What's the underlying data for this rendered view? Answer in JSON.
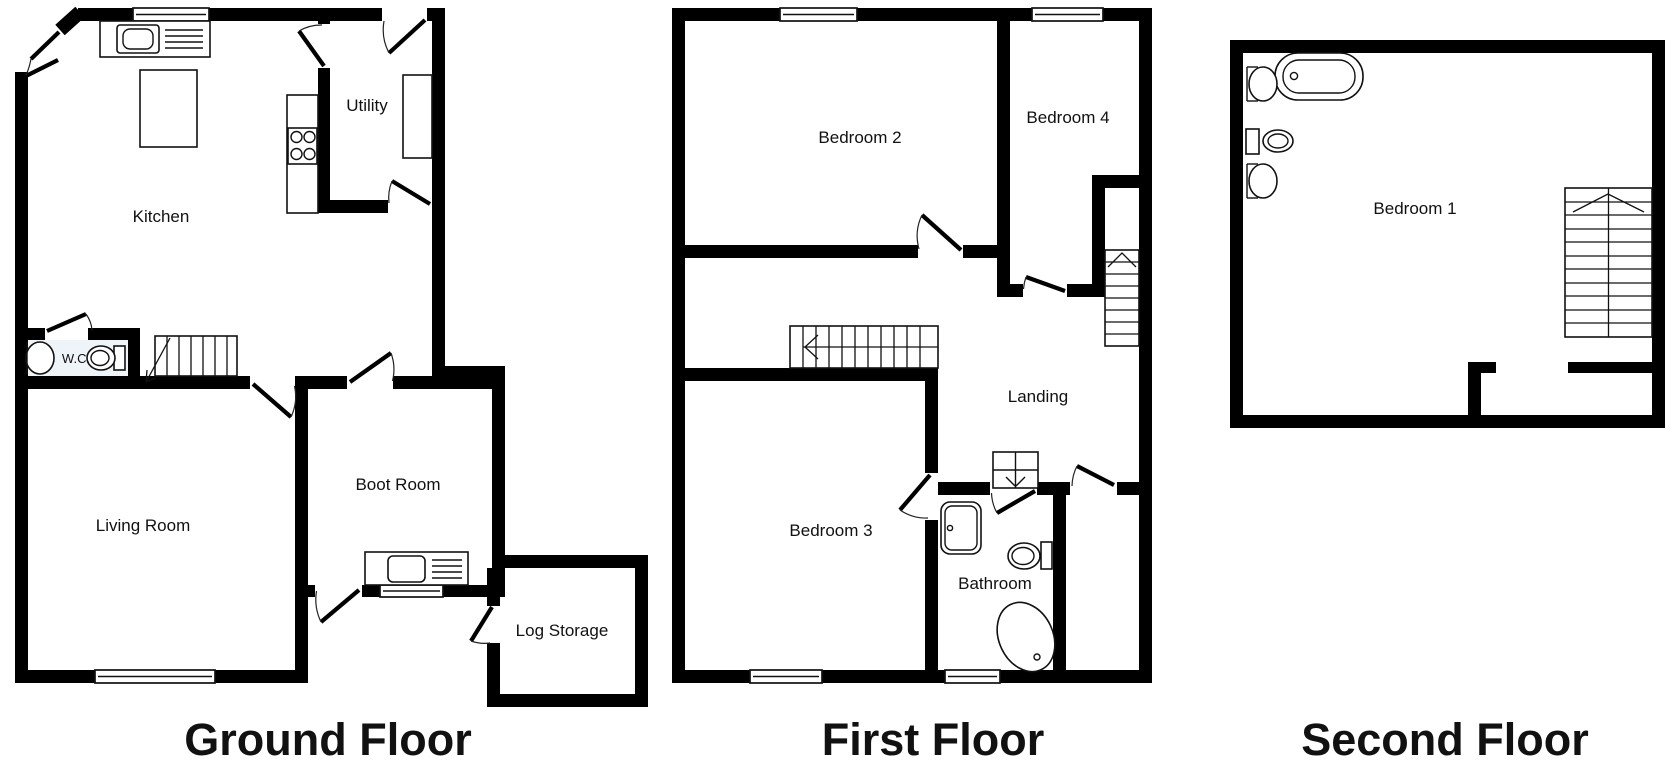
{
  "document": {
    "type": "floor-plan",
    "floor_count": 3
  },
  "colors": {
    "background": "#ffffff",
    "walls": "#000000",
    "fixture_lines": "#111111",
    "wc_floor_tint": "#eef4f7"
  },
  "floors": [
    {
      "label": "Ground Floor",
      "rooms": [
        {
          "name": "Kitchen"
        },
        {
          "name": "Utility"
        },
        {
          "name": "W.C."
        },
        {
          "name": "Living Room"
        },
        {
          "name": "Boot Room"
        },
        {
          "name": "Log Storage"
        }
      ],
      "fixtures": [
        "kitchen-sink",
        "drainer",
        "kitchen-island",
        "hob",
        "utility-appliance",
        "wc-basin",
        "wc-toilet",
        "staircase-up",
        "boot-room-sink",
        "window",
        "door-swing",
        "corner-double-door"
      ]
    },
    {
      "label": "First Floor",
      "rooms": [
        {
          "name": "Bedroom 2"
        },
        {
          "name": "Bedroom 4"
        },
        {
          "name": "Landing"
        },
        {
          "name": "Bedroom 3"
        },
        {
          "name": "Bathroom"
        }
      ],
      "fixtures": [
        "staircase-down",
        "staircase-up",
        "shower-cubicle",
        "bathroom-basin",
        "bathroom-toilet",
        "bathtub",
        "window",
        "door-swing"
      ]
    },
    {
      "label": "Second Floor",
      "rooms": [
        {
          "name": "Bedroom 1"
        }
      ],
      "fixtures": [
        "bathtub",
        "basin",
        "toilet",
        "basin",
        "staircase-down",
        "wall-stub"
      ]
    }
  ]
}
